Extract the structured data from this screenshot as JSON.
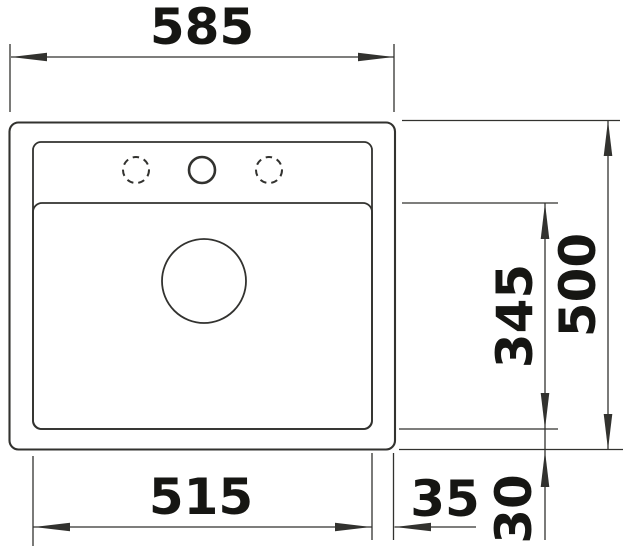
{
  "meta": {
    "type": "technical-dimension-drawing",
    "subject": "single-bowl-inset-sink-top-view",
    "background_color": "#ffffff",
    "line_color": "#32322f",
    "text_color": "#161613",
    "unit": "mm"
  },
  "dimensions": {
    "overall_width": "585",
    "overall_depth": "500",
    "bowl_depth": "345",
    "bowl_width": "515",
    "right_edge_offset": "35",
    "bottom_edge_offset": "30"
  }
}
